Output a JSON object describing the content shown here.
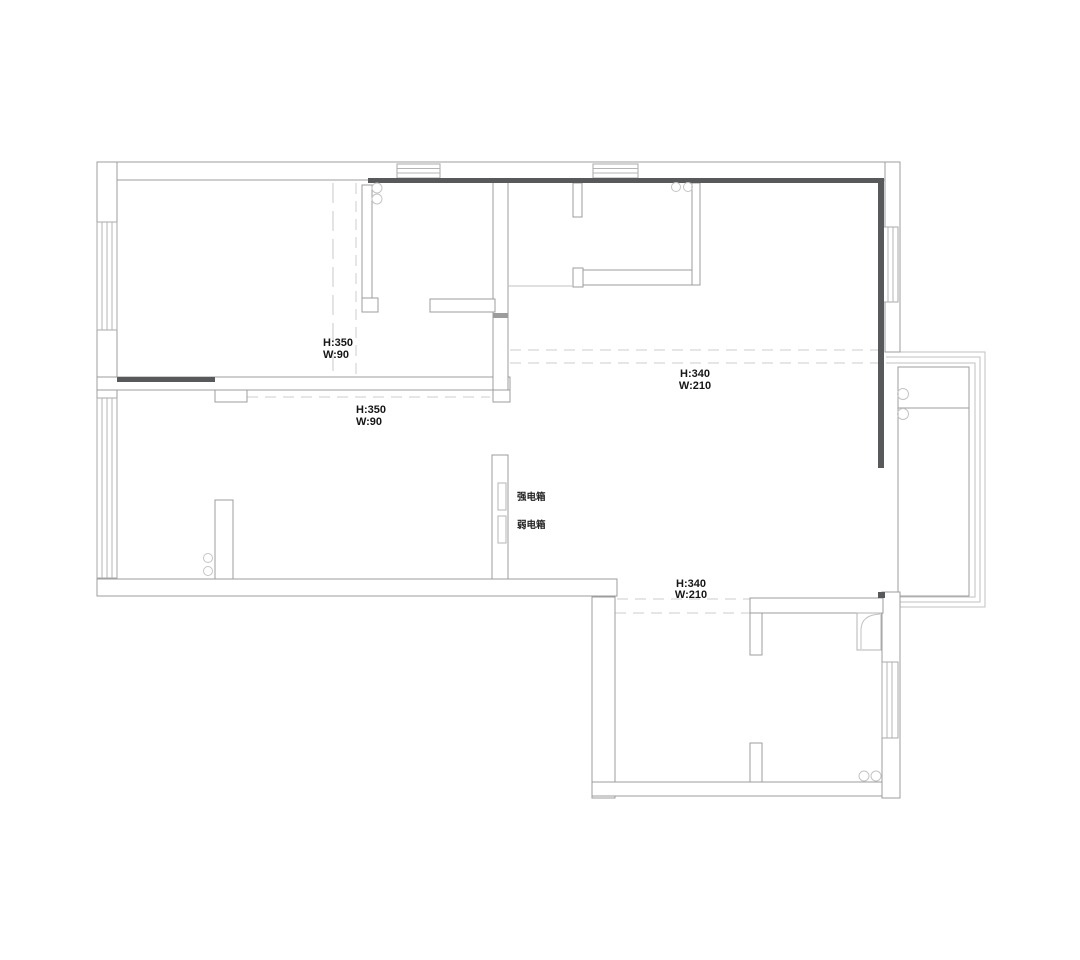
{
  "document": {
    "type": "floor-plan"
  },
  "colors": {
    "background": "#ffffff",
    "wall_line": "#9c9c9c",
    "dark_wall": "#58595b",
    "dashed_line": "#cdcdcd",
    "light_line": "#c2c2c2",
    "text": "#161616"
  },
  "annotations": [
    {
      "id": "opening-top-left",
      "line1": "H:350",
      "line2": "W:90"
    },
    {
      "id": "opening-mid-left",
      "line1": "H:350",
      "line2": "W:90"
    },
    {
      "id": "opening-living",
      "line1": "H:340",
      "line2": "W:210"
    },
    {
      "id": "opening-bottom-room",
      "line1": "H:340",
      "line2": "W:210"
    }
  ],
  "equipment_labels": [
    {
      "id": "strong-electric-box",
      "label": "强电箱"
    },
    {
      "id": "weak-electric-box",
      "label": "弱电箱"
    }
  ]
}
